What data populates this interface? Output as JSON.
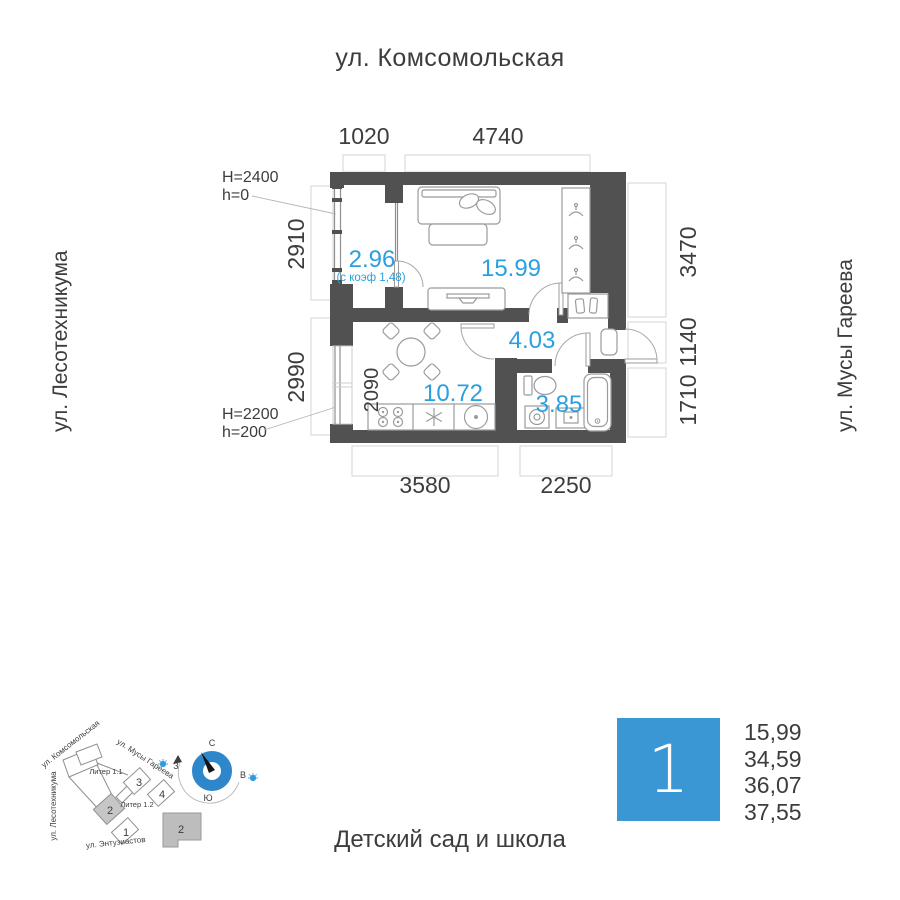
{
  "streets": {
    "top": "ул. Комсомольская",
    "left": "ул. Лесотехникума",
    "right": "ул. Мусы Гареева",
    "bottom": "Детский сад и школа"
  },
  "plan": {
    "areas": {
      "balcony": "2.96",
      "balcony_note": "(с коэф 1,48)",
      "living": "15.99",
      "hall": "4.03",
      "kitchen": "10.72",
      "bath": "3.85"
    },
    "dims": {
      "top_left": "1020",
      "top_right": "4740",
      "left_upper": "2910",
      "left_lower": "2990",
      "right_upper": "3470",
      "right_mid": "1140",
      "right_lower": "1710",
      "bottom_left": "3580",
      "bottom_right": "2250",
      "kitchen_inner": "2090"
    },
    "notes": {
      "top_line1": "H=2400",
      "top_line2": "h=0",
      "bottom_line1": "H=2200",
      "bottom_line2": "h=200"
    }
  },
  "site": {
    "street_komsomolskaya": "ул. Комсомольская",
    "street_musy_gareeva": "ул. Мусы Гареева",
    "street_lesotehnikuma": "ул. Лесотехникума",
    "street_entuziastov": "ул. Энтузиастов",
    "liter_1_1": "Литер 1.1",
    "liter_1_2": "Литер 1.2",
    "sections": {
      "s1": "1",
      "s2": "2",
      "s3": "3",
      "s4": "4"
    },
    "footprint_label": "2",
    "compass": {
      "north": "С",
      "south": "Ю",
      "west": "З",
      "east": "В"
    }
  },
  "legend": {
    "apartment_number": "1",
    "values": [
      "15,99",
      "34,59",
      "36,07",
      "37,55"
    ]
  },
  "colors": {
    "accent_blue": "#2b9fdf",
    "legend_blue": "#3b97d3",
    "wall": "#515151",
    "text": "#3d3d3d"
  }
}
